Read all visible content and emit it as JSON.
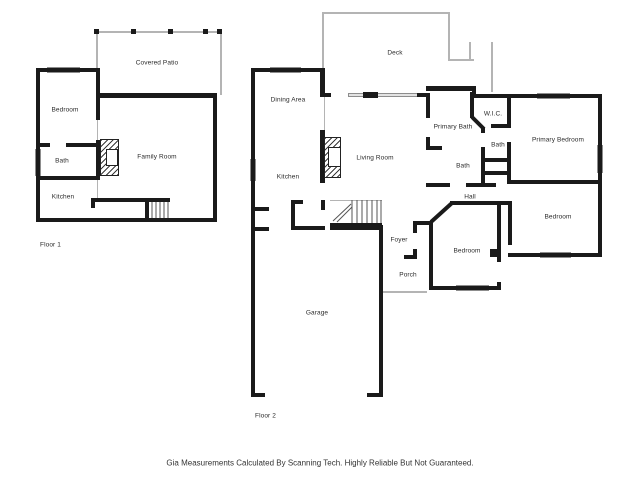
{
  "disclaimer": "Gia Measurements Calculated By Scanning Tech. Highly Reliable But Not Guaranteed.",
  "plan": {
    "colors": {
      "wall": "#1a1a1a",
      "window_fill": "#e3e3e3",
      "outline_gray": "#b4b4b4",
      "label_text": "#2b2b2b"
    },
    "labels": [
      {
        "id": "covered-patio",
        "text": "Covered Patio",
        "x": 157,
        "y": 63
      },
      {
        "id": "bedroom-f1",
        "text": "Bedroom",
        "x": 65,
        "y": 110
      },
      {
        "id": "bath-f1",
        "text": "Bath",
        "x": 62,
        "y": 161
      },
      {
        "id": "kitchen-f1",
        "text": "Kitchen",
        "x": 63,
        "y": 197
      },
      {
        "id": "family-room",
        "text": "Family Room",
        "x": 157,
        "y": 157
      },
      {
        "id": "floor-1",
        "text": "Floor 1",
        "x": 40,
        "y": 245,
        "align": "left"
      },
      {
        "id": "deck",
        "text": "Deck",
        "x": 395,
        "y": 53
      },
      {
        "id": "dining-area",
        "text": "Dining Area",
        "x": 288,
        "y": 100
      },
      {
        "id": "kitchen-f2",
        "text": "Kitchen",
        "x": 288,
        "y": 177
      },
      {
        "id": "living-room",
        "text": "Living Room",
        "x": 375,
        "y": 158
      },
      {
        "id": "primary-bath",
        "text": "Primary Bath",
        "x": 453,
        "y": 127
      },
      {
        "id": "wic",
        "text": "W.I.C.",
        "x": 493,
        "y": 114
      },
      {
        "id": "bath-upper",
        "text": "Bath",
        "x": 498,
        "y": 145
      },
      {
        "id": "primary-bedroom",
        "text": "Primary Bedroom",
        "x": 558,
        "y": 140
      },
      {
        "id": "bath-lower",
        "text": "Bath",
        "x": 463,
        "y": 166
      },
      {
        "id": "hall",
        "text": "Hall",
        "x": 470,
        "y": 197
      },
      {
        "id": "bedroom-right",
        "text": "Bedroom",
        "x": 558,
        "y": 217
      },
      {
        "id": "bedroom-mid",
        "text": "Bedroom",
        "x": 467,
        "y": 251
      },
      {
        "id": "foyer",
        "text": "Foyer",
        "x": 399,
        "y": 240
      },
      {
        "id": "porch",
        "text": "Porch",
        "x": 408,
        "y": 275
      },
      {
        "id": "garage",
        "text": "Garage",
        "x": 317,
        "y": 313
      },
      {
        "id": "floor-2",
        "text": "Floor 2",
        "x": 255,
        "y": 416,
        "align": "left"
      }
    ],
    "walls": [
      [
        36,
        68,
        64,
        4
      ],
      [
        36,
        68,
        4,
        154
      ],
      [
        36,
        218,
        181,
        4
      ],
      [
        213,
        95,
        4,
        127
      ],
      [
        96,
        93,
        121,
        5
      ],
      [
        96,
        68,
        4,
        52
      ],
      [
        96,
        140,
        4,
        40
      ],
      [
        36,
        143,
        14,
        4
      ],
      [
        66,
        143,
        34,
        4
      ],
      [
        36,
        176,
        64,
        4
      ],
      [
        91,
        198,
        79,
        4
      ],
      [
        91,
        198,
        4,
        10
      ],
      [
        145,
        202,
        4,
        20
      ],
      [
        251,
        68,
        4,
        329
      ],
      [
        251,
        68,
        73,
        4
      ],
      [
        320,
        68,
        5,
        29
      ],
      [
        325,
        93,
        6,
        4
      ],
      [
        417,
        93,
        13,
        4
      ],
      [
        426,
        93,
        4,
        25
      ],
      [
        426,
        137,
        4,
        11
      ],
      [
        426,
        86,
        50,
        5
      ],
      [
        472,
        86,
        4,
        12
      ],
      [
        472,
        94,
        130,
        4
      ],
      [
        598,
        94,
        4,
        89
      ],
      [
        426,
        146,
        16,
        4
      ],
      [
        470,
        92,
        4,
        26
      ],
      [
        491,
        124,
        18,
        4
      ],
      [
        507,
        94,
        4,
        34
      ],
      [
        507,
        142,
        4,
        42
      ],
      [
        481,
        128,
        4,
        5
      ],
      [
        481,
        147,
        4,
        15
      ],
      [
        481,
        158,
        29,
        4
      ],
      [
        481,
        162,
        4,
        25
      ],
      [
        485,
        171,
        23,
        4
      ],
      [
        426,
        183,
        24,
        4
      ],
      [
        466,
        183,
        30,
        4
      ],
      [
        450,
        201,
        52,
        4
      ],
      [
        508,
        180,
        94,
        4
      ],
      [
        598,
        183,
        4,
        74
      ],
      [
        497,
        201,
        15,
        4
      ],
      [
        497,
        205,
        4,
        57
      ],
      [
        497,
        282,
        4,
        8
      ],
      [
        508,
        205,
        4,
        40
      ],
      [
        508,
        253,
        94,
        4
      ],
      [
        429,
        221,
        4,
        69
      ],
      [
        413,
        221,
        20,
        4
      ],
      [
        413,
        221,
        4,
        12
      ],
      [
        413,
        249,
        4,
        10
      ],
      [
        404,
        255,
        13,
        4
      ],
      [
        429,
        286,
        72,
        4
      ],
      [
        490,
        249,
        8,
        8
      ],
      [
        379,
        225,
        4,
        172
      ],
      [
        251,
        393,
        14,
        4
      ],
      [
        367,
        393,
        16,
        4
      ],
      [
        251,
        207,
        18,
        4
      ],
      [
        251,
        227,
        18,
        4
      ],
      [
        291,
        200,
        4,
        30
      ],
      [
        291,
        200,
        12,
        4
      ],
      [
        321,
        200,
        4,
        10
      ],
      [
        291,
        226,
        34,
        4
      ],
      [
        330,
        223,
        52,
        7
      ],
      [
        320,
        130,
        5,
        53
      ],
      [
        363,
        92,
        15,
        6
      ]
    ],
    "windows": [
      [
        47,
        67,
        33,
        6
      ],
      [
        35,
        149,
        6,
        27
      ],
      [
        103,
        93,
        46,
        5
      ],
      [
        155,
        93,
        40,
        5
      ],
      [
        198,
        93,
        14,
        5
      ],
      [
        270,
        67,
        31,
        6
      ],
      [
        250,
        159,
        6,
        22
      ],
      [
        348,
        93,
        72,
        4
      ],
      [
        436,
        86,
        29,
        5
      ],
      [
        537,
        93,
        33,
        6
      ],
      [
        597,
        145,
        6,
        28
      ],
      [
        456,
        285,
        33,
        6
      ],
      [
        540,
        252,
        31,
        6
      ]
    ],
    "thin_lines": [
      [
        96,
        31,
        126,
        2
      ],
      [
        96,
        31,
        2,
        38
      ],
      [
        220,
        31,
        2,
        64
      ],
      [
        322,
        12,
        128,
        2
      ],
      [
        322,
        12,
        2,
        57
      ],
      [
        448,
        12,
        2,
        49
      ],
      [
        448,
        59,
        26,
        2
      ],
      [
        469,
        42,
        2,
        19
      ],
      [
        491,
        42,
        2,
        50
      ],
      [
        383,
        291,
        44,
        2
      ],
      [
        324,
        97,
        1,
        33
      ],
      [
        97,
        120,
        1,
        20
      ],
      [
        97,
        180,
        1,
        18
      ],
      [
        330,
        200,
        52,
        1
      ]
    ],
    "posts": [
      [
        94,
        29,
        5,
        5
      ],
      [
        131,
        29,
        5,
        5
      ],
      [
        168,
        29,
        5,
        5
      ],
      [
        203,
        29,
        5,
        5
      ],
      [
        217,
        29,
        5,
        5
      ]
    ],
    "diagonal_walls": [
      [
        472,
        117,
        484,
        129
      ],
      [
        452,
        203,
        431,
        222
      ]
    ],
    "stair_treads": [
      [
        152,
        202,
        152,
        218
      ],
      [
        156,
        202,
        156,
        218
      ],
      [
        160,
        202,
        160,
        218
      ],
      [
        164,
        202,
        164,
        218
      ],
      [
        168,
        202,
        168,
        218
      ],
      [
        352,
        200,
        352,
        223
      ],
      [
        357,
        200,
        357,
        223
      ],
      [
        362,
        200,
        362,
        223
      ],
      [
        367,
        200,
        367,
        223
      ],
      [
        372,
        200,
        372,
        223
      ],
      [
        377,
        200,
        377,
        223
      ],
      [
        381,
        200,
        381,
        223
      ]
    ],
    "stair_arrows": [
      [
        333,
        221,
        351,
        204
      ],
      [
        337,
        222,
        352,
        207
      ]
    ],
    "fireplaces": [
      {
        "box": [
          100,
          139,
          19,
          37
        ],
        "inner": [
          106,
          149,
          12,
          17
        ]
      },
      {
        "box": [
          324,
          137,
          17,
          41
        ],
        "inner": [
          328,
          147,
          13,
          20
        ]
      }
    ]
  }
}
